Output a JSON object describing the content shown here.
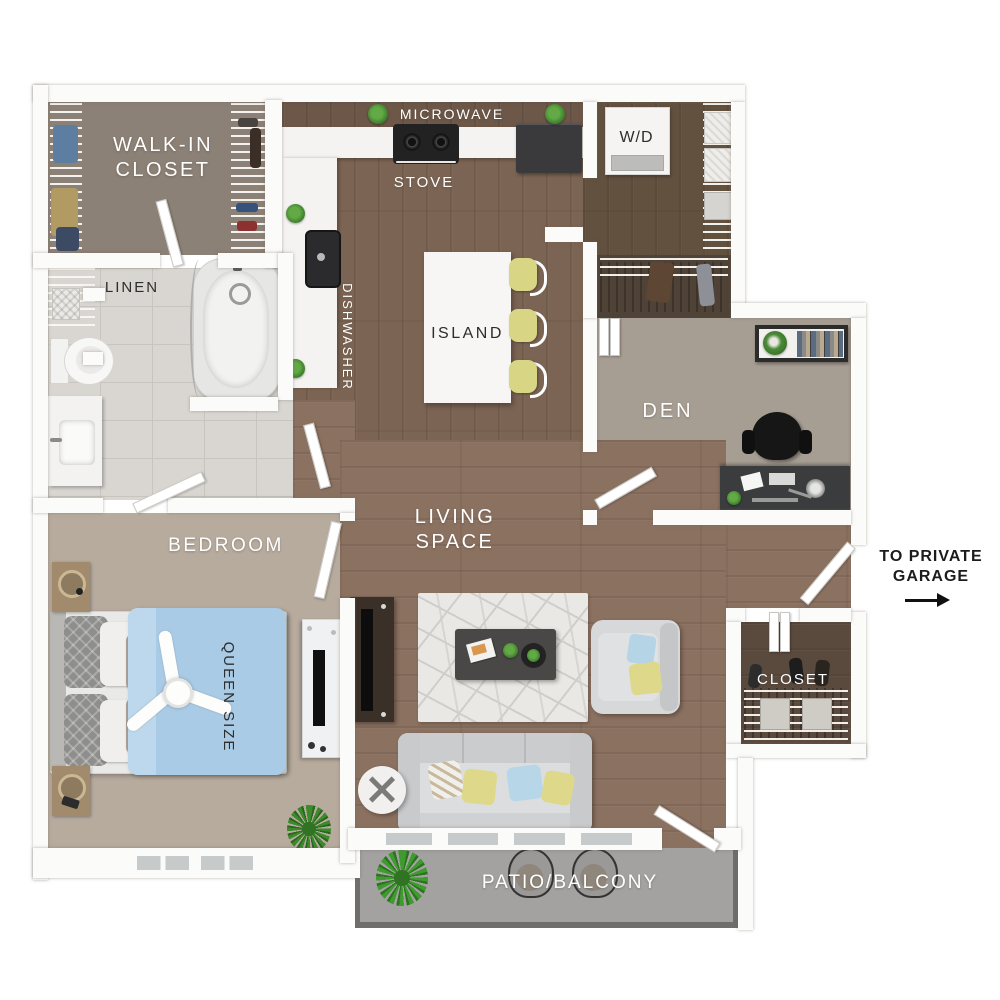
{
  "labels": {
    "walk_in_closet": "WALK-IN\nCLOSET",
    "linen": "LINEN",
    "microwave": "MICROWAVE",
    "stove": "STOVE",
    "dishwasher": "DISHWASHER",
    "washer_dryer": "W/D",
    "island": "ISLAND",
    "den": "DEN",
    "living_space": "LIVING\nSPACE",
    "bedroom": "BEDROOM",
    "queen_size": "QUEEN SIZE",
    "closet": "CLOSET",
    "patio": "PATIO/BALCONY",
    "garage_note": "TO PRIVATE\nGARAGE"
  },
  "palette": {
    "wall": "#fbfbfa",
    "wood_living": "#8b7160",
    "wood_kitchen": "#7b6453",
    "wood_dark": "#5f4e42",
    "floor_walkin": "#8c8176",
    "floor_den": "#a79e93",
    "floor_bedroom": "#b7ab9e",
    "tile_bath": "#d9d6d1",
    "patio_concrete": "#a3a2a0",
    "patio_border": "#6f6e6c",
    "bed_duvet": "#aacbe5",
    "stool_yellow": "#d8d584",
    "pillow_yellow": "#ded98a",
    "pillow_blue": "#b5d4e6",
    "label_light": "#ffffff",
    "label_dark": "#2d2d2d"
  }
}
